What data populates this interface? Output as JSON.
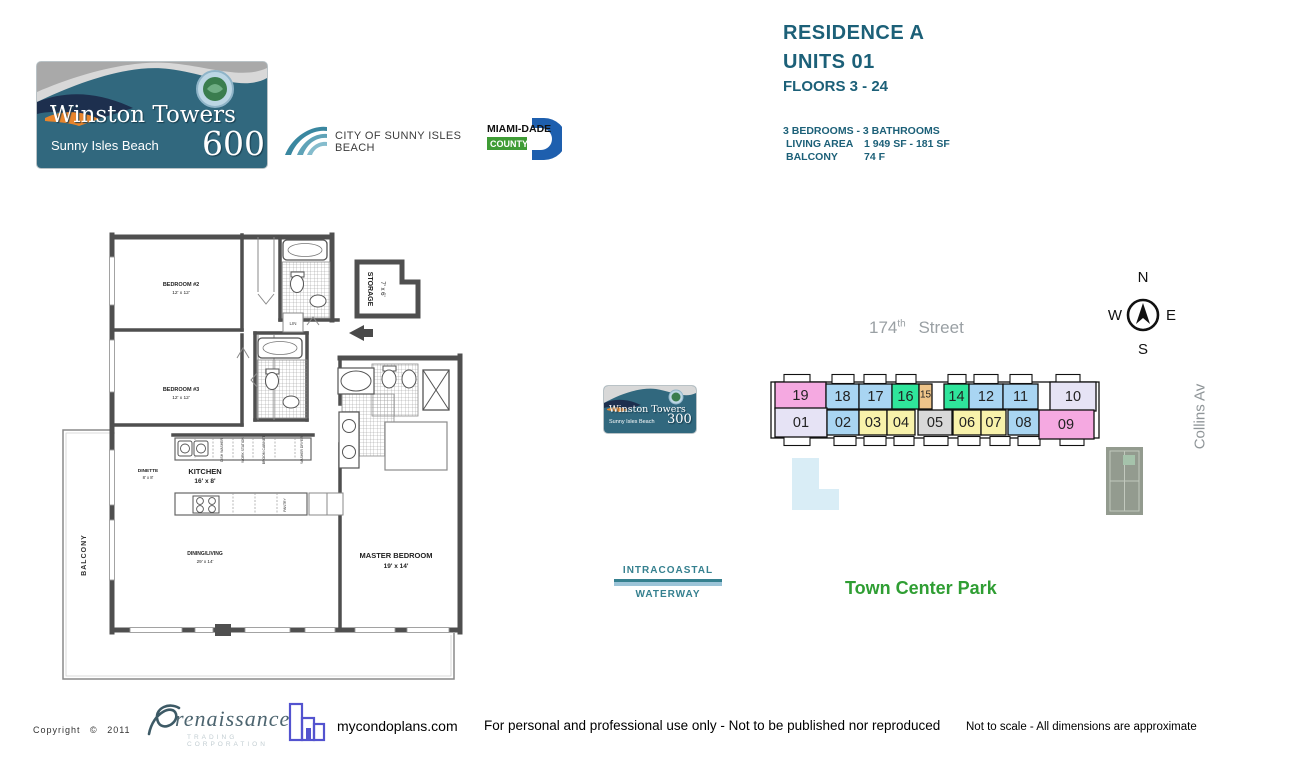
{
  "brand": {
    "winston600": {
      "name": "Winston Towers",
      "city": "Sunny Isles Beach",
      "number": "600"
    },
    "winston300": {
      "name": "Winston Towers",
      "city": "Sunny Isles Beach",
      "number": "300"
    },
    "city_logo_label": "CITY OF SUNNY ISLES BEACH",
    "county": {
      "name": "MIAMI-DADE",
      "word": "COUNTY"
    }
  },
  "header": {
    "residence": "RESIDENCE A",
    "units": "UNITS 01",
    "floors": "FLOORS 3 - 24",
    "bedrooms": "3 BEDROOMS - 3 BATHROOMS",
    "living_area_label": "LIVING AREA",
    "living_area_value": "1 949 SF - 181 SF",
    "balcony_label": "BALCONY",
    "balcony_value": "74 F"
  },
  "floorplan": {
    "bedroom2": {
      "name": "BEDROOM #2",
      "dims": "12' x 12'"
    },
    "bedroom3": {
      "name": "BEDROOM #3",
      "dims": "12' x 12'"
    },
    "storage": {
      "name": "STORAGE",
      "dims": "7' x 6'"
    },
    "dinette": {
      "name": "DINETTE",
      "dims": "8' x 8'"
    },
    "kitchen": {
      "name": "KITCHEN",
      "dims": "16' x 8'"
    },
    "living": {
      "name": "DINING/LIVING",
      "dims": "29' x 14'"
    },
    "master": {
      "name": "MASTER BEDROOM",
      "dims": "19' x 14'"
    },
    "balcony_label": "BALCONY",
    "linen_label": "LIN",
    "pantry_label": "PANTRY",
    "appliance_labels": [
      "DISH WASHER",
      "WORK STATION",
      "BROOM CABINET",
      "WASHER DRYER"
    ]
  },
  "sitemap": {
    "street_number": "174",
    "street_sup": "th",
    "street_word": "Street",
    "compass": {
      "north": "N",
      "south": "S",
      "east": "E",
      "west": "W"
    },
    "collins": "Collins Av",
    "waterway_line1": "INTRACOASTAL",
    "waterway_line2": "WATERWAY",
    "park": "Town Center Park",
    "units_top": [
      {
        "num": "19",
        "color": "#f5a9e1"
      },
      {
        "num": "18",
        "color": "#a9d5f2"
      },
      {
        "num": "17",
        "color": "#a9d5f2"
      },
      {
        "num": "16",
        "color": "#2fe59b"
      },
      {
        "num": "15",
        "color": "#eec489"
      },
      {
        "num": "14",
        "color": "#2fe59b"
      },
      {
        "num": "12",
        "color": "#a9d5f2"
      },
      {
        "num": "11",
        "color": "#a9d5f2"
      },
      {
        "num": "10",
        "color": "#e6e3f5"
      }
    ],
    "units_bottom": [
      {
        "num": "01",
        "color": "#e6e3f5"
      },
      {
        "num": "02",
        "color": "#a9d5f2"
      },
      {
        "num": "03",
        "color": "#f8f2ab"
      },
      {
        "num": "04",
        "color": "#f8f2ab"
      },
      {
        "num": "05",
        "color": "#d9d9d9"
      },
      {
        "num": "06",
        "color": "#f8f2ab"
      },
      {
        "num": "07",
        "color": "#f8f2ab"
      },
      {
        "num": "08",
        "color": "#a9d5f2"
      },
      {
        "num": "09",
        "color": "#f5a9e1"
      }
    ]
  },
  "footer": {
    "copyright": "Copyright",
    "copyright_symbol": "©",
    "year": "2011",
    "renaissance": "renaissance",
    "renaissance_sub": "TRADING CORPORATION",
    "site": "mycondoplans.com",
    "disclaimer1": "For personal and professional use only - Not to be published nor reproduced",
    "disclaimer2": "Not to scale - All dimensions are approximate"
  },
  "colors": {
    "accent_teal": "#1c6078",
    "street_gray": "#9aa0a4",
    "park_green": "#2f9e33",
    "waterway_teal": "#35808f",
    "collins_gray": "#8f9598",
    "logo_teal": "#31687e"
  }
}
